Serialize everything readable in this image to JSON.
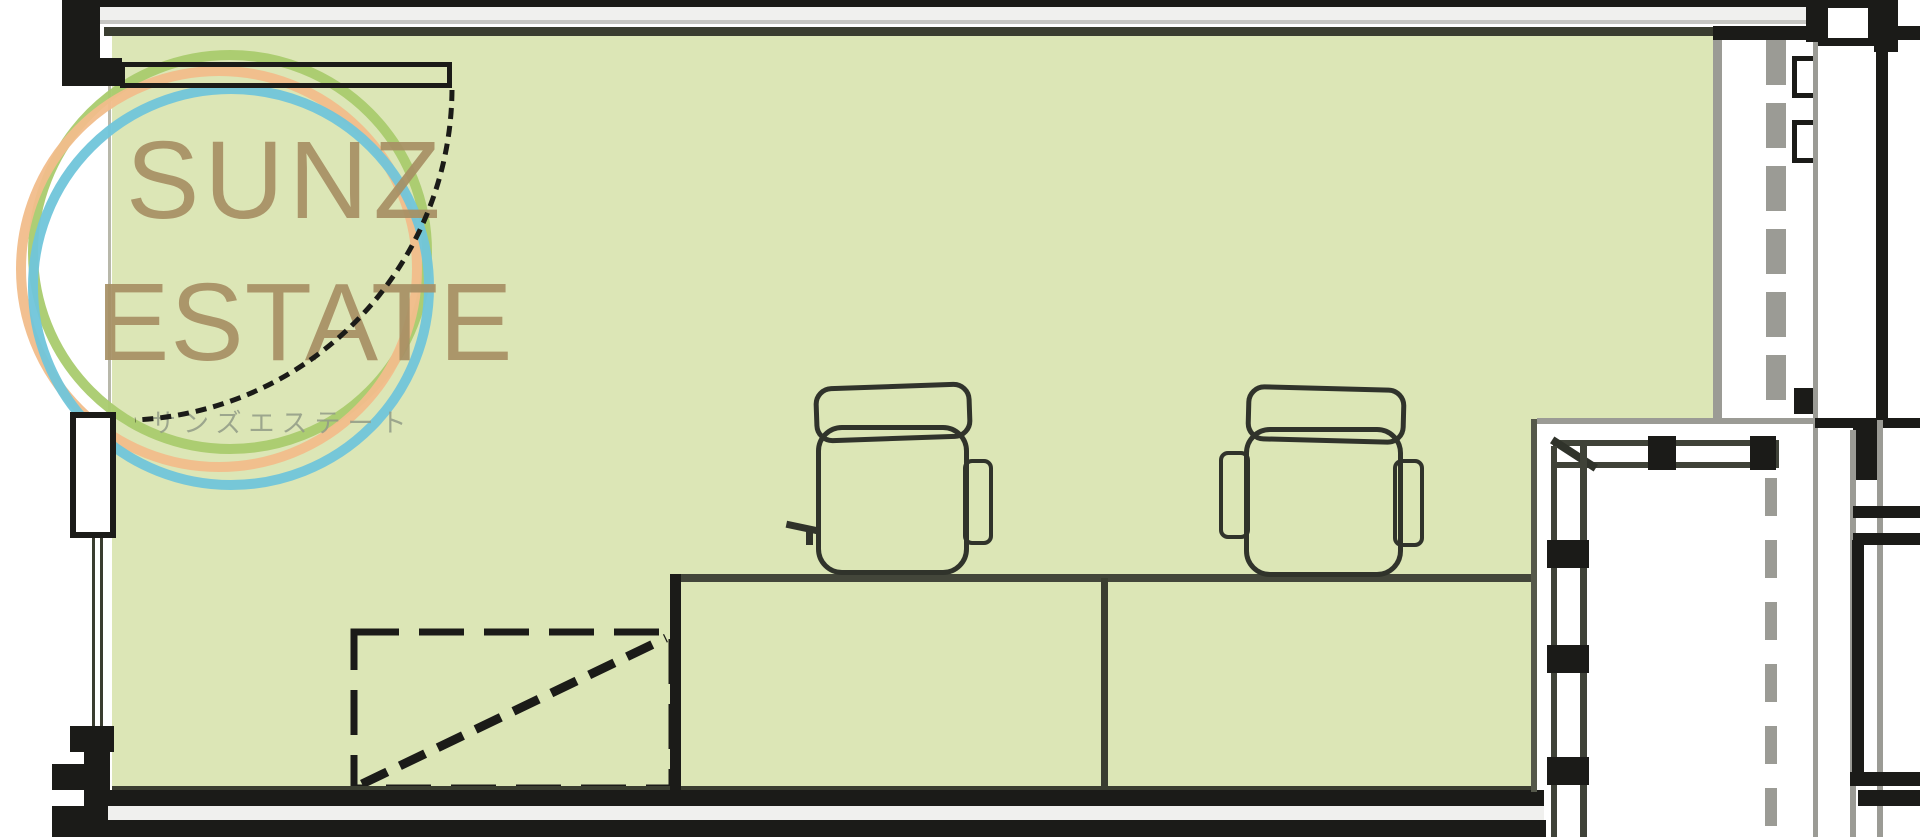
{
  "page": {
    "kind": "real-estate floor plan image",
    "canvas": {
      "width": 1920,
      "height": 837
    }
  },
  "watermark": {
    "brand_line1": "SUNZ",
    "brand_line2": "ESTATE",
    "brand_line3_jp": "サンズエステート"
  },
  "palette": {
    "room_fill": "#dce6b6",
    "wall_dark": "#1b1b18",
    "wall_gray": "#9b9b95",
    "wall_light": "#f0f0ee",
    "line_olive": "#3a3d30",
    "line_faint": "#b8b8aa",
    "furn_line": "#30332b",
    "ring_green": "#a9cb6e",
    "ring_orange": "#f1bd8b",
    "ring_blue": "#70c5da",
    "brand_text": "#a79064",
    "jp_text": "#919b87"
  },
  "plan": {
    "room_label": "office-room",
    "furniture": [
      {
        "name": "double-desk"
      },
      {
        "name": "office-chair-left"
      },
      {
        "name": "office-chair-right"
      },
      {
        "name": "dashed-storage-area"
      }
    ],
    "features": [
      {
        "name": "door-swing-arc"
      },
      {
        "name": "door-panel"
      },
      {
        "name": "window-pillar"
      },
      {
        "name": "balcony-window-frame"
      },
      {
        "name": "sliding-door-dashed-track"
      }
    ]
  }
}
